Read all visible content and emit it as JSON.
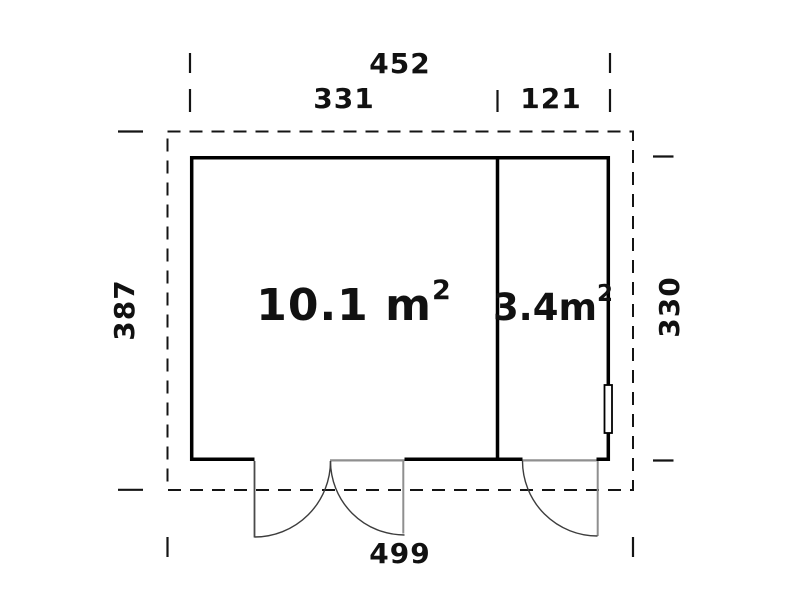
{
  "plan": {
    "dimensions": {
      "top_overall": "452",
      "top_left_room": "331",
      "top_right_room": "121",
      "left_side": "387",
      "right_side": "330",
      "bottom_overall": "499"
    },
    "rooms": {
      "main": {
        "area": "10.1 m",
        "sup": "2"
      },
      "side": {
        "area": "3.4m",
        "sup": "2"
      }
    },
    "colors": {
      "wall": "#000000",
      "dashed": "#141414",
      "tick": "#141414",
      "door": "#8f8f8f",
      "door_dark": "#4a4a4a",
      "arc": "#3d3d3d",
      "window_fill": "#ffffff"
    }
  }
}
